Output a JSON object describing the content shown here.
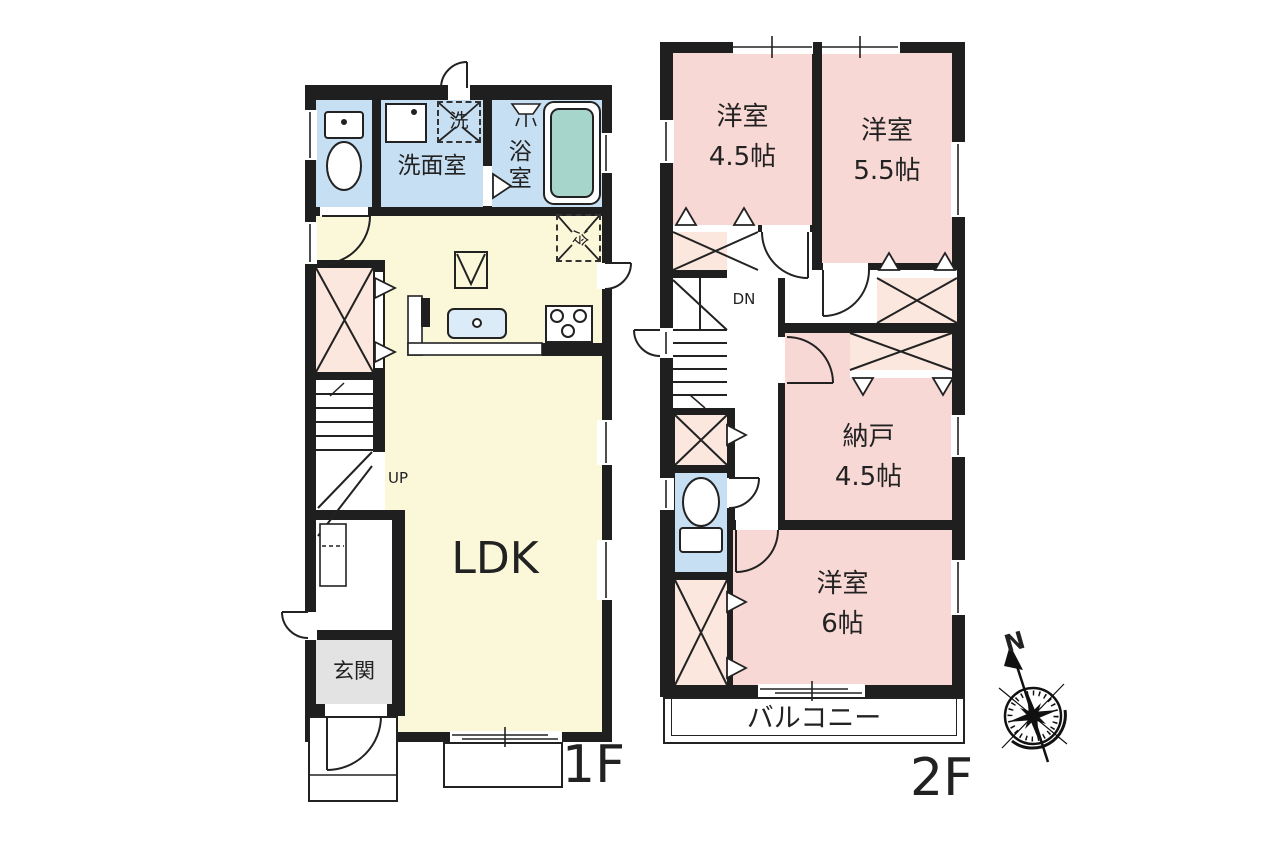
{
  "colors": {
    "wall": "#1f1f1f",
    "room_pink": "#f8d8d4",
    "closet_pink": "#fbe7de",
    "living_yellow": "#fbf8da",
    "water_blue": "#c7dff2",
    "tub_teal": "#a6d5cc",
    "entrance_gray": "#e3e3e3",
    "line": "#222222"
  },
  "floor1": {
    "label": "1F",
    "ldk": "LDK",
    "entrance": "玄関",
    "washroom": "洗面室",
    "bathroom": "浴室",
    "laundry_symbol": "洗",
    "fridge_symbol": "冷",
    "stairs": "UP"
  },
  "floor2": {
    "label": "2F",
    "bedroom_a_name": "洋室",
    "bedroom_a_size": "4.5帖",
    "bedroom_b_name": "洋室",
    "bedroom_b_size": "5.5帖",
    "storage_name": "納戸",
    "storage_size": "4.5帖",
    "bedroom_c_name": "洋室",
    "bedroom_c_size": "6帖",
    "balcony": "バルコニー",
    "stairs": "DN"
  },
  "compass": {
    "north_label": "N"
  }
}
